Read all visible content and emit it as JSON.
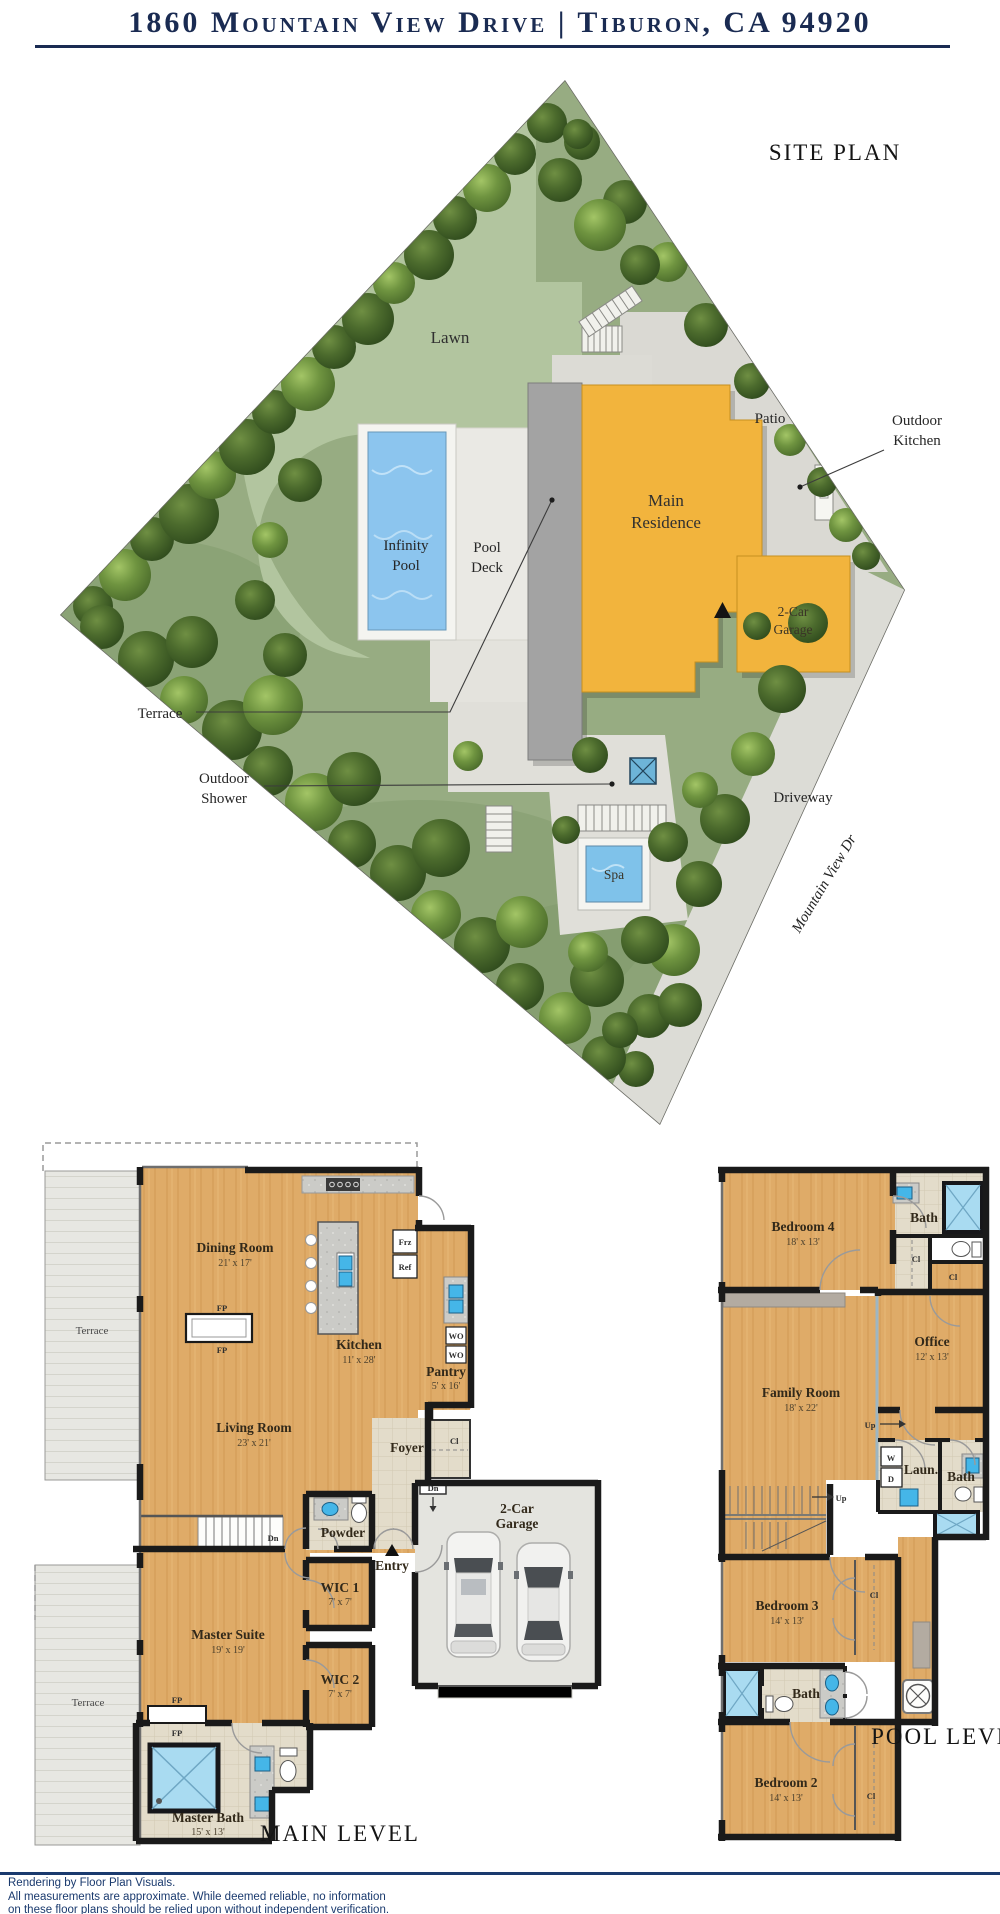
{
  "header": {
    "title": "1860 Mountain View Drive | Tiburon, CA 94920"
  },
  "site_plan": {
    "title": "SITE PLAN",
    "street_name": "Mountain View Dr",
    "labels": {
      "lawn": "Lawn",
      "infinity_pool_line1": "Infinity",
      "infinity_pool_line2": "Pool",
      "pool_deck_line1": "Pool",
      "pool_deck_line2": "Deck",
      "main_residence_line1": "Main",
      "main_residence_line2": "Residence",
      "garage_line1": "2-Car",
      "garage_line2": "Garage",
      "patio": "Patio",
      "outdoor_kitchen_line1": "Outdoor",
      "outdoor_kitchen_line2": "Kitchen",
      "terrace": "Terrace",
      "outdoor_shower_line1": "Outdoor",
      "outdoor_shower_line2": "Shower",
      "driveway": "Driveway",
      "spa": "Spa"
    }
  },
  "main_level": {
    "title": "MAIN LEVEL",
    "rooms": {
      "dining": {
        "name": "Dining Room",
        "dims": "21' x 17'"
      },
      "kitchen": {
        "name": "Kitchen",
        "dims": "11' x 28'"
      },
      "pantry": {
        "name": "Pantry",
        "dims": "5' x 16'"
      },
      "living": {
        "name": "Living Room",
        "dims": "23' x 21'"
      },
      "master_suite": {
        "name": "Master Suite",
        "dims": "19' x 19'"
      },
      "master_bath": {
        "name": "Master Bath",
        "dims": "15' x 13'"
      },
      "wic1": {
        "name": "WIC 1",
        "dims": "7' x 7'"
      },
      "wic2": {
        "name": "WIC 2",
        "dims": "7' x 7'"
      },
      "garage_line1": "2-Car",
      "garage_line2": "Garage",
      "foyer": "Foyer",
      "powder": "Powder",
      "entry": "Entry",
      "terrace": "Terrace"
    },
    "tags": {
      "fp": "FP",
      "frz": "Frz",
      "ref": "Ref",
      "wo": "WO",
      "dn": "Dn",
      "cl": "Cl"
    }
  },
  "pool_level": {
    "title": "POOL LEVEL",
    "rooms": {
      "bedroom4": {
        "name": "Bedroom 4",
        "dims": "18' x 13'"
      },
      "office": {
        "name": "Office",
        "dims": "12' x 13'"
      },
      "family": {
        "name": "Family Room",
        "dims": "18' x 22'"
      },
      "bedroom3": {
        "name": "Bedroom 3",
        "dims": "14' x 13'"
      },
      "bedroom2": {
        "name": "Bedroom 2",
        "dims": "14' x 13'"
      },
      "bath": "Bath",
      "laundry": "Laun."
    },
    "tags": {
      "up": "Up",
      "cl": "Cl",
      "w": "W",
      "d": "D"
    }
  },
  "footer": {
    "line1": "Rendering by Floor Plan Visuals.",
    "line2": "All measurements are approximate. While deemed reliable, no information",
    "line3": "on these floor plans should be relied upon without independent verification."
  }
}
